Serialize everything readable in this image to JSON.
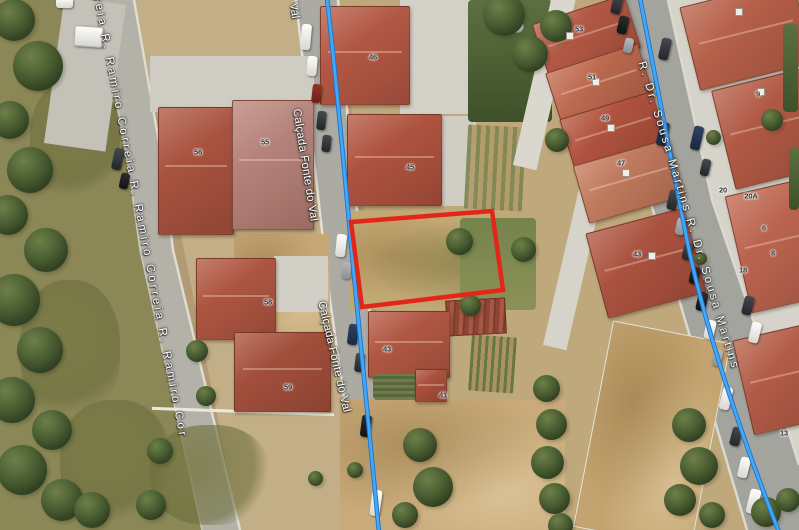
{
  "map": {
    "view": "satellite",
    "colors": {
      "plot_outline": "#e3261a",
      "route_line": "#42a8f2",
      "route_line_edge": "#1f70cf"
    },
    "streets": {
      "ramiro_correia": {
        "name": "R. Ramiro Correia",
        "label_display": "reia R. Ramiro Correia R. Ramiro Correia R. Ramiro Cor"
      },
      "calcada_fonte_do_val": {
        "name": "Calçada Fonte do Val",
        "label_top": "Val"
      },
      "sousa_martins": {
        "name": "R. Dr. Sousa Martins",
        "label_display": "R. Dr. Sousa Martins  R. Dr. Sousa Martins"
      }
    },
    "plot": {
      "points": "351,222 492,211 503,290 362,307"
    },
    "routes": {
      "calcada": "M327,-2 C338,95 345,180 353,265 C361,350 370,440 379,532",
      "sousa": "M640,-2 C656,80 671,160 687,240 C703,320 739,430 779,532"
    },
    "house_numbers": [
      {
        "label": "46"
      },
      {
        "label": "45"
      },
      {
        "label": "43"
      },
      {
        "label": "41"
      },
      {
        "label": "56"
      },
      {
        "label": "55"
      },
      {
        "label": "58"
      },
      {
        "label": "59"
      },
      {
        "label": "53"
      },
      {
        "label": "51"
      },
      {
        "label": "49"
      },
      {
        "label": "47"
      },
      {
        "label": "43"
      },
      {
        "label": "9"
      },
      {
        "label": "20"
      },
      {
        "label": "20A"
      },
      {
        "label": "6"
      },
      {
        "label": "8"
      },
      {
        "label": "18"
      },
      {
        "label": "13"
      }
    ]
  }
}
